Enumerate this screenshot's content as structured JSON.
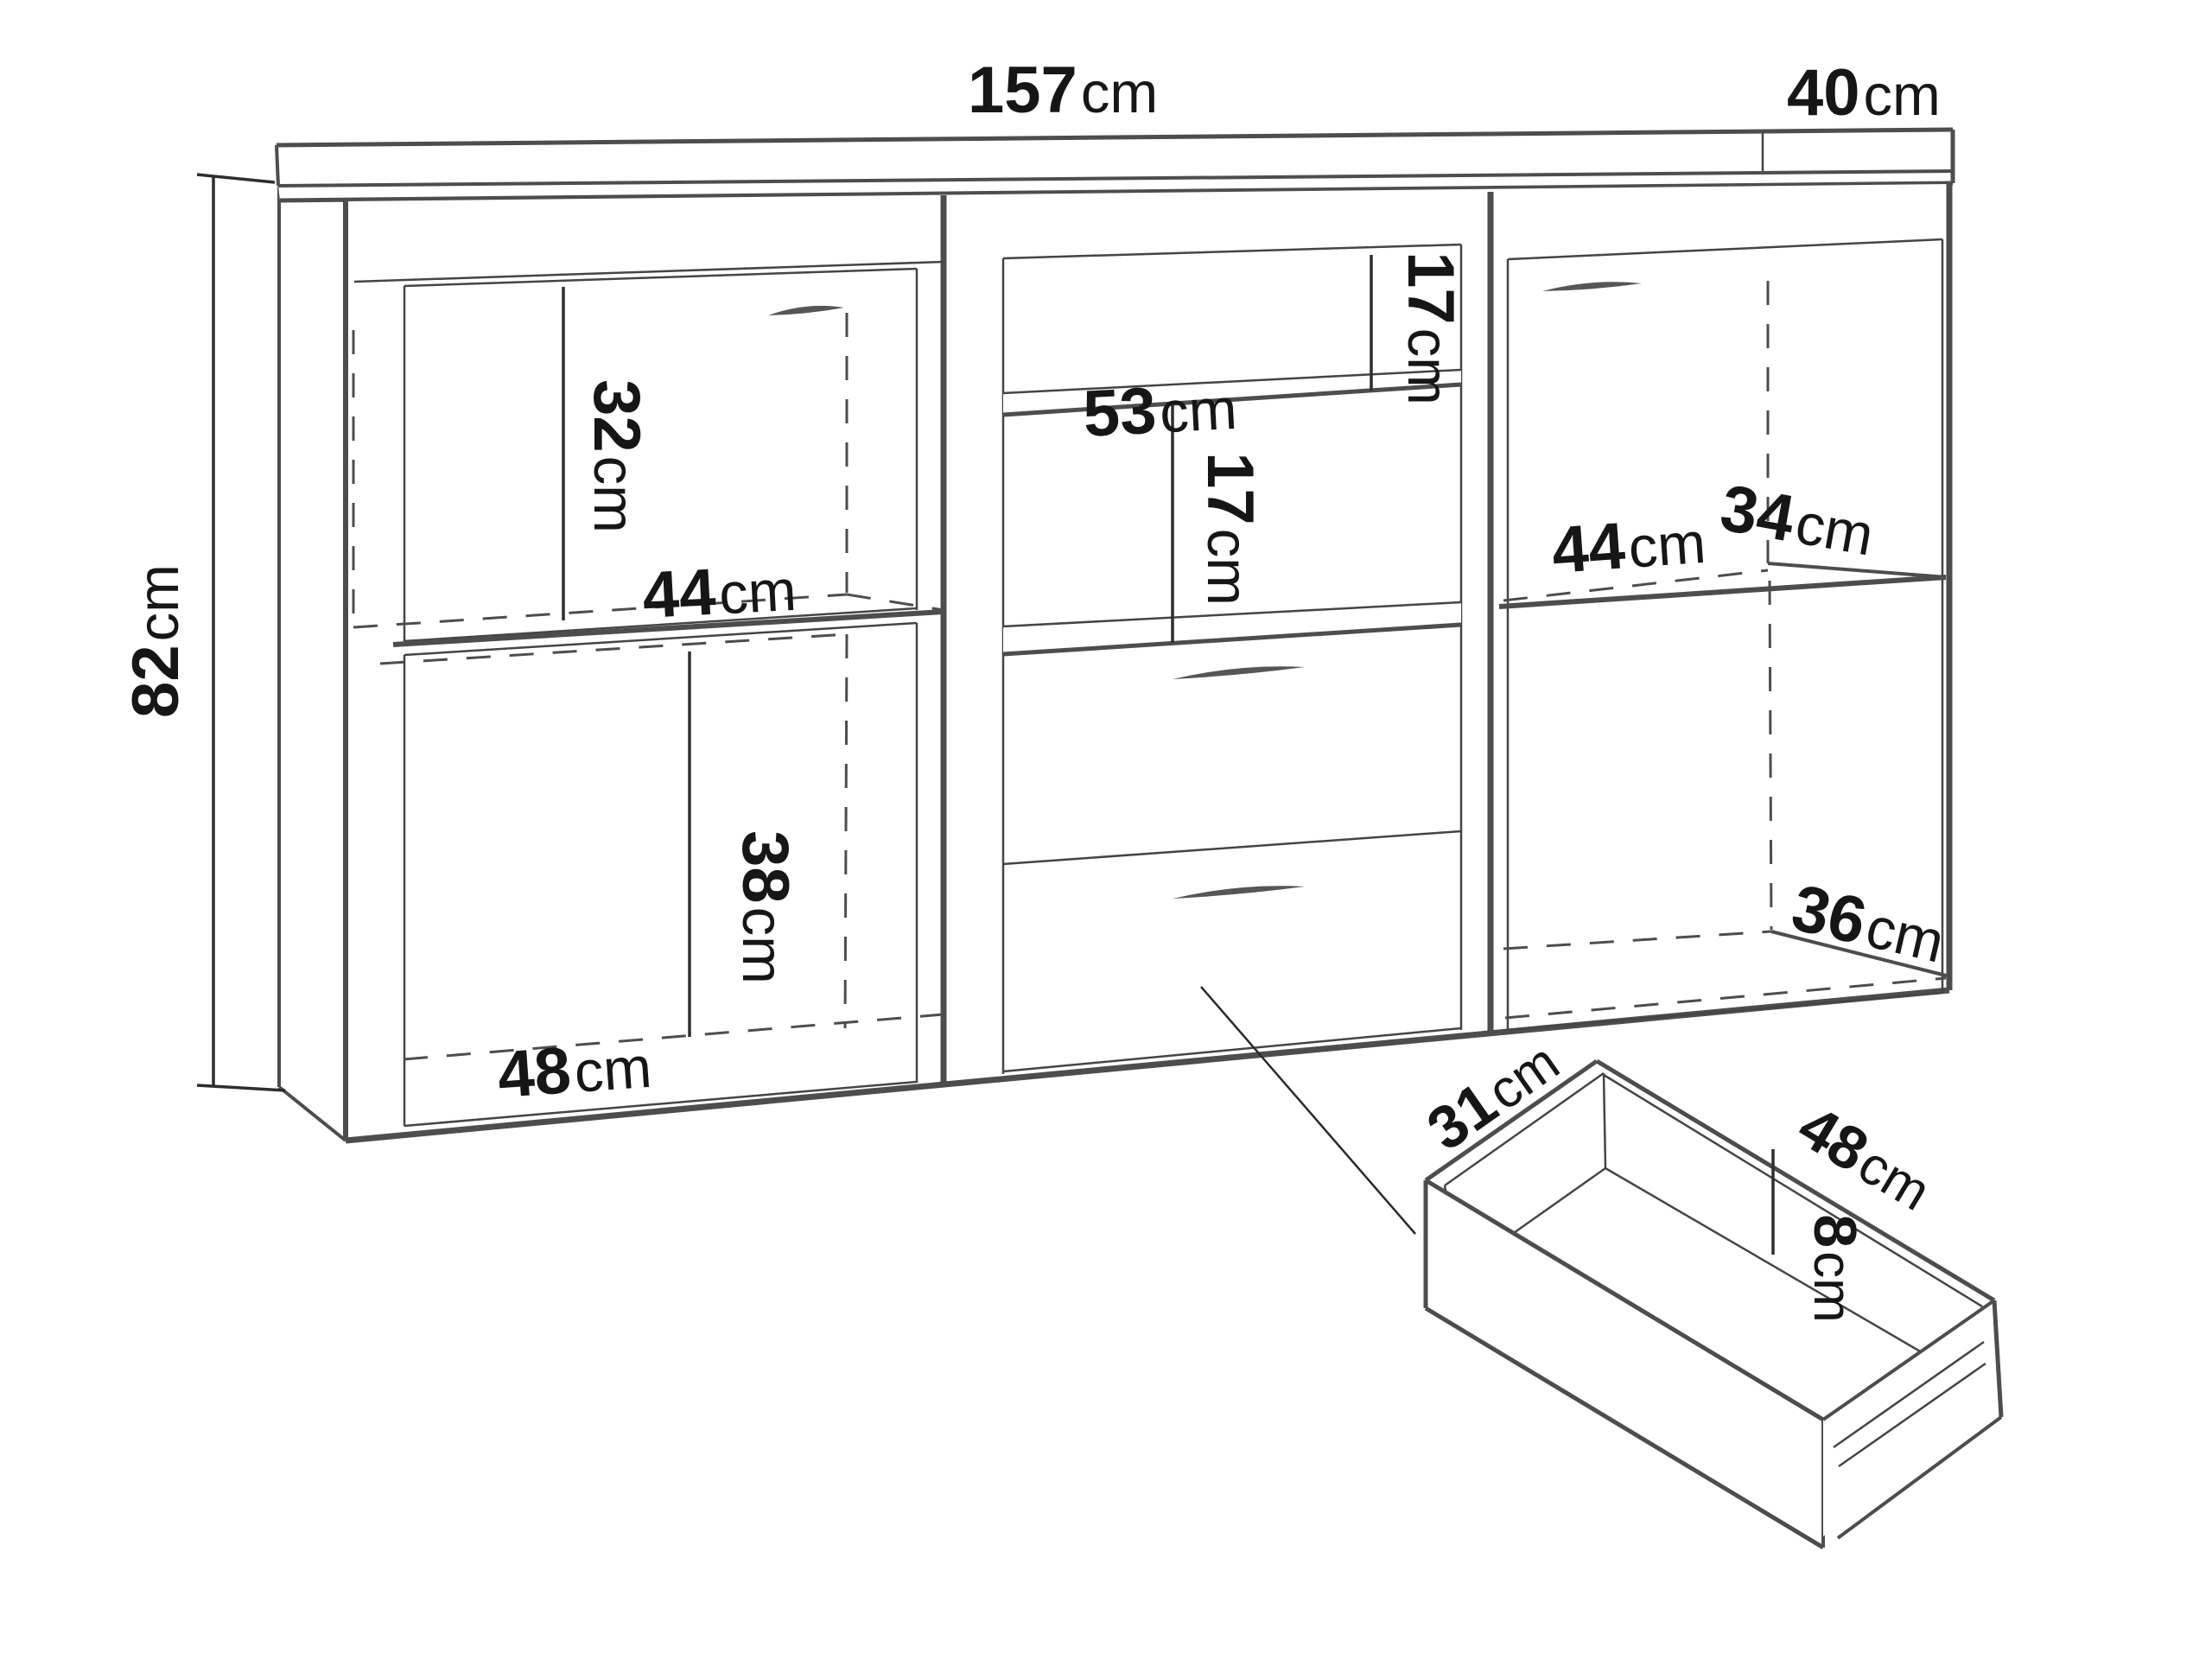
{
  "diagram": {
    "type": "furniture-dimension-diagram",
    "subject": "sideboard-with-drawer-detail",
    "background_color": "#ffffff",
    "line_color": "#4d4d4d",
    "text_color": "#161616"
  },
  "labels": {
    "width_top": {
      "value": "157",
      "unit": "cm"
    },
    "depth_top": {
      "value": "40",
      "unit": "cm"
    },
    "height_left": {
      "value": "82",
      "unit": "cm"
    },
    "upper_left_height": {
      "value": "32",
      "unit": "cm"
    },
    "upper_left_width": {
      "value": "44",
      "unit": "cm"
    },
    "middle_shelf_width": {
      "value": "53",
      "unit": "cm"
    },
    "middle_upper_niche_height": {
      "value": "17",
      "unit": "cm"
    },
    "middle_lower_niche_height": {
      "value": "17",
      "unit": "cm"
    },
    "right_width": {
      "value": "44",
      "unit": "cm"
    },
    "right_depth_top": {
      "value": "34",
      "unit": "cm"
    },
    "right_depth_bottom": {
      "value": "36",
      "unit": "cm"
    },
    "lower_left_height": {
      "value": "38",
      "unit": "cm"
    },
    "lower_left_width": {
      "value": "48",
      "unit": "cm"
    },
    "drawer_depth": {
      "value": "31",
      "unit": "cm"
    },
    "drawer_width": {
      "value": "48",
      "unit": "cm"
    },
    "drawer_inner_height": {
      "value": "8",
      "unit": "cm"
    }
  }
}
